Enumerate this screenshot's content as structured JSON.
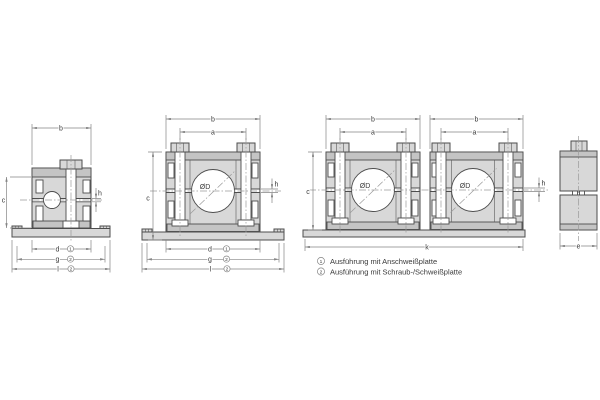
{
  "drawing": {
    "type": "technical-drawing-pipe-clamps",
    "labels": {
      "b": "b",
      "a": "a",
      "c": "c",
      "d": "d",
      "g": "g",
      "l": "l",
      "h": "h",
      "k": "k",
      "e": "e",
      "bore": "ØD"
    },
    "refs": {
      "d": "1",
      "g": "2",
      "l": "2"
    },
    "legend": {
      "items": [
        {
          "num": "1",
          "text": "Ausführung mit Anschweißplatte"
        },
        {
          "num": "2",
          "text": "Ausführung mit Schraub-/Schweißplatte"
        }
      ]
    },
    "colors": {
      "outline": "#4d4d4d",
      "fill_light": "#d8d8d8",
      "fill_mid": "#c4c4c4",
      "dim": "#858585",
      "centerline": "#9a9a9a",
      "background": "#ffffff"
    }
  }
}
